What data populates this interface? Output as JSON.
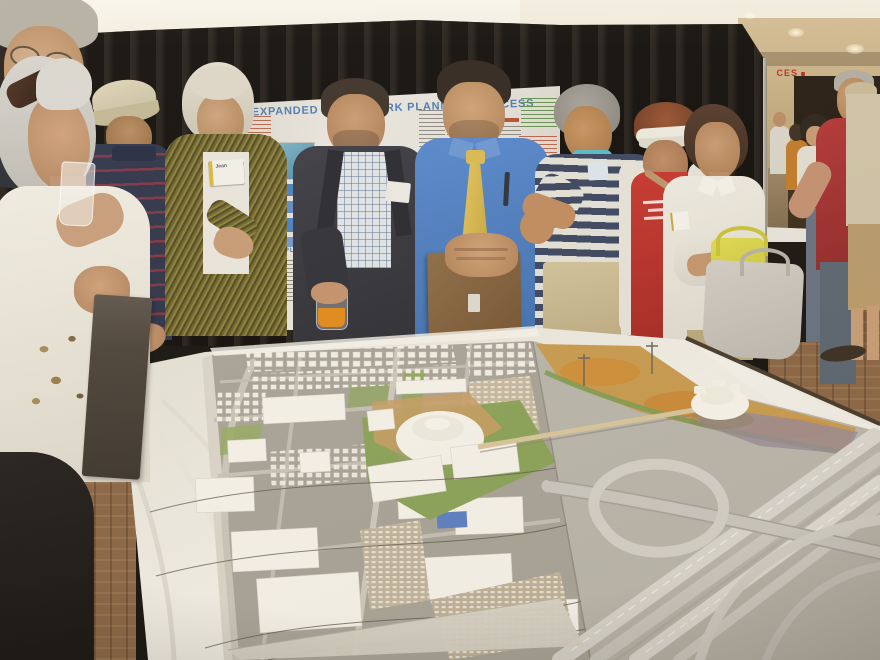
{
  "poster": {
    "title": "EXPANDED FRAMEWORK PLANNING PROCESS",
    "flow_label": "PLAN"
  },
  "badges": {
    "presenter_name_tag": "Jean"
  },
  "mall": {
    "storefront_sign": "CES"
  },
  "palette": {
    "curtain": "#16120e",
    "ceiling": "#f0e9d8",
    "poster_title_blue": "#4a7ab0",
    "tablecloth": "#edeae0",
    "model_hill_gold": "#c89a4e",
    "presenter_shirt_blue": "#4d7fc4",
    "tie_gold": "#d9b84e",
    "tee_red": "#bd3028",
    "bag_chartreuse": "#d8d348",
    "juice_orange": "#e08a18",
    "wood_floor": "#8a6544"
  },
  "people": [
    "man with glasses, partial, foreground left",
    "white-haired woman holding clear drink, foreground left",
    "man in beige ball cap and navy striped polo",
    "docent in olive metallic jacket with Jean name tag",
    "man in charcoal blazer holding orange juice cup",
    "presenter in blue shirt and gold tie resting hands on display board",
    "gray-haired man in navy striped shirt gesturing",
    "woman in white sun visor and red tee with cardigan",
    "woman in white blouse carrying chartreuse and gray bags",
    "man in dark red polo, background right",
    "man in tan shirt, shorts and sandals, background right"
  ],
  "model_features": [
    "aerial-photo base with street grid",
    "rows of small white residential house models",
    "large white commercial building blocks",
    "round arena-style building",
    "campus lawns and tan parking lots with model cars",
    "multi-lane freeway interchange with loop ramps",
    "golden hillside parkland with orange patches",
    "white drum building on hillside",
    "thin pedestrian bridge across the freeway",
    "utility wires and poles"
  ]
}
